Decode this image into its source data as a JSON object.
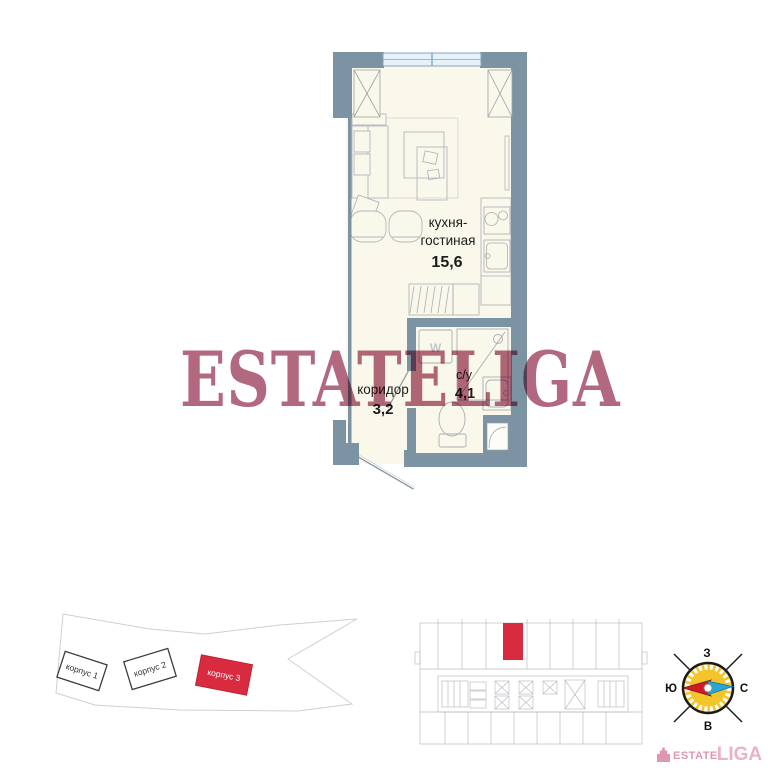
{
  "apartment_plan": {
    "room_kitchen_living": {
      "name_line1": "кухня-",
      "name_line2": "гостиная",
      "area": "15,6"
    },
    "room_corridor": {
      "name": "коридор",
      "area": "3,2"
    },
    "room_bathroom": {
      "name": "с/у",
      "area": "4,1"
    },
    "washer_label": "W"
  },
  "watermark": {
    "text": "ESTATELIGA"
  },
  "site_plan": {
    "buildings": [
      {
        "label": "корпус 1",
        "highlighted": false
      },
      {
        "label": "корпус 2",
        "highlighted": false
      },
      {
        "label": "корпус 3",
        "highlighted": true
      }
    ]
  },
  "floor_overview": {
    "highlighted_unit": true
  },
  "compass": {
    "top": "З",
    "right": "С",
    "bottom": "В",
    "left": "Ю"
  },
  "logo": {
    "estate": "ESTATE",
    "liga": "LIGA"
  },
  "colors": {
    "wall": "#7b93a2",
    "floor": "#faf8ea",
    "highlight_red": "#d92b3f",
    "watermark_rose": "#a8546e",
    "compass_yellow": "#f3c52a",
    "needle_red": "#d01a28",
    "needle_blue": "#25a7d7",
    "logo_pink": "#e0a0b4"
  }
}
